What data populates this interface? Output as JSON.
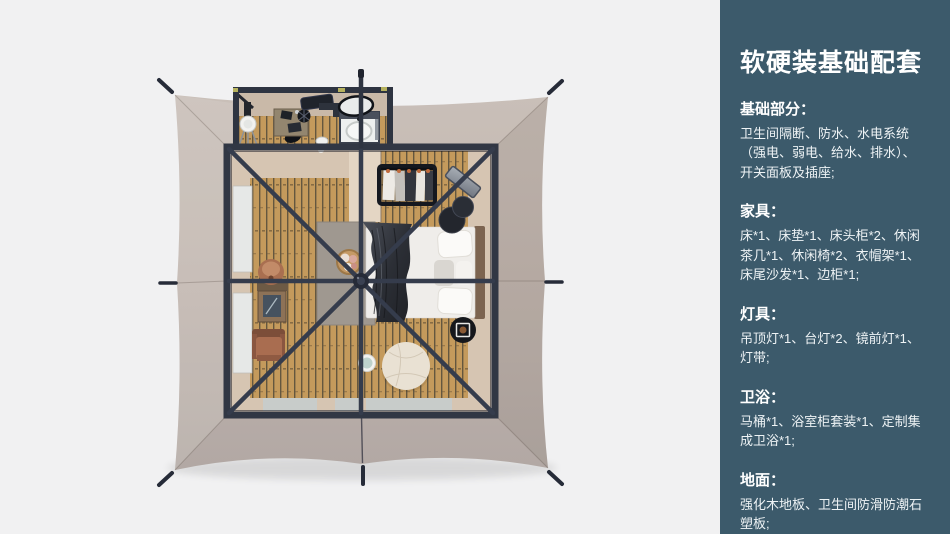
{
  "palette": {
    "background": "#f1f1f2",
    "sidebar_background": "#3c5a6b",
    "sidebar_text": "#eef3f5",
    "canopy_fabric": "#c2b7af",
    "canopy_fabric_dark": "#b3a8a2",
    "frame_dark": "#313744",
    "wood_floor": "#c49a5c",
    "beige_floor": "#d6c5b2",
    "rug_gray": "#9f9890",
    "bed_white": "#f0eeeb",
    "blanket_dark": "#33363d",
    "terracotta": "#a96d50",
    "pouf_cream": "#e9e1d3",
    "window_gray": "#e6e8e7",
    "accent_yellow": "#b6b25e"
  },
  "sidebar": {
    "title": "软硬装基础配套",
    "sections": [
      {
        "heading": "基础部分：",
        "body": "卫生间隔断、防水、水电系统（强电、弱电、给水、排水）、开关面板及插座;"
      },
      {
        "heading": "家具：",
        "body": "床*1、床垫*1、床头柜*2、休闲茶几*1、休闲椅*2、衣帽架*1、床尾沙发*1、边柜*1;"
      },
      {
        "heading": "灯具：",
        "body": "吊顶灯*1、台灯*2、镜前灯*1、灯带;"
      },
      {
        "heading": "卫浴：",
        "body": "马桶*1、浴室柜套装*1、定制集成卫浴*1;"
      },
      {
        "heading": "地面：",
        "body": "强化木地板、卫生间防滑防潮石塑板;"
      }
    ]
  },
  "floor_plan": {
    "view": "top-down tent room render",
    "items": [
      "tent-canopy",
      "guy-line-stakes",
      "frame-poles",
      "center-hub",
      "bathroom",
      "vanity-desk",
      "round-mirror",
      "shower-tray",
      "toilet",
      "standing-fan",
      "bed",
      "pillows",
      "throw-blanket",
      "headboard",
      "area-rug",
      "storage-basket",
      "clothes-rack",
      "leaning-mirror",
      "nesting-tables",
      "armchair",
      "ceramic-stool",
      "wall-mirror",
      "bean-bag-pouf",
      "side-table",
      "round-tray-table",
      "window-panels",
      "floor-mats"
    ]
  }
}
